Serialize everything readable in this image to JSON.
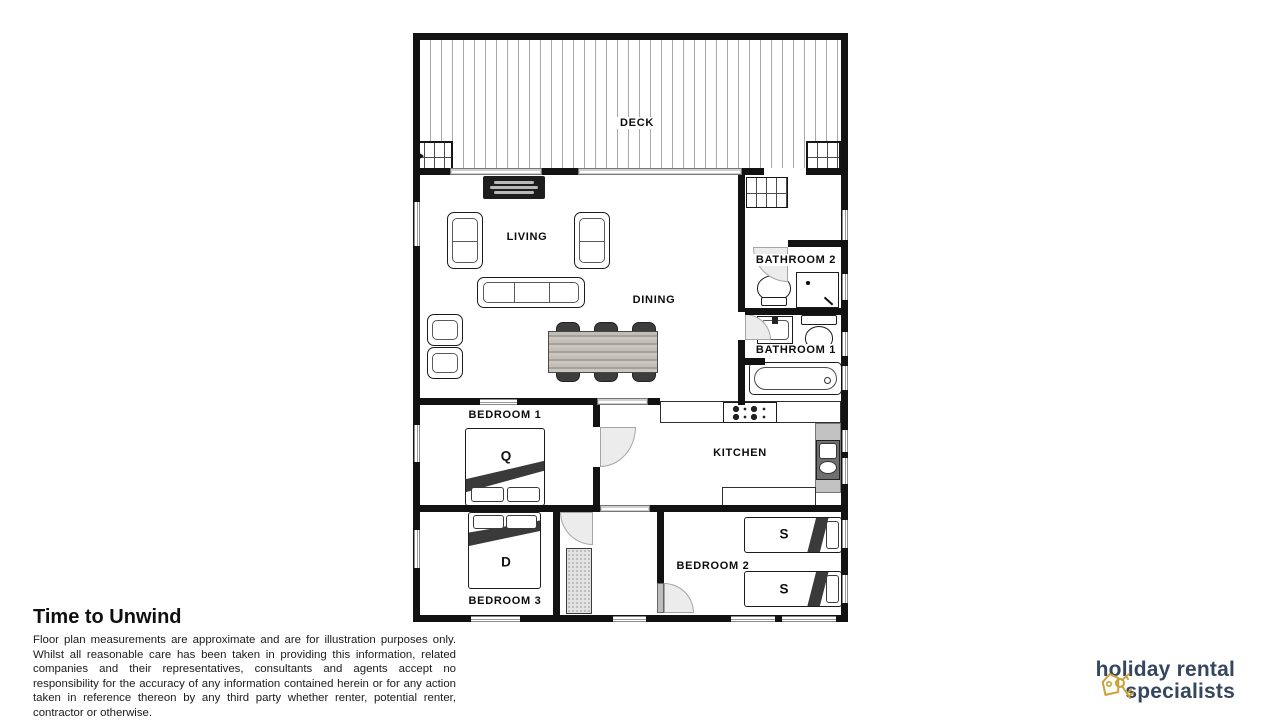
{
  "floorplan": {
    "rooms": [
      {
        "name": "deck",
        "label": "DECK"
      },
      {
        "name": "living",
        "label": "LIVING"
      },
      {
        "name": "dining",
        "label": "DINING"
      },
      {
        "name": "bathroom-2",
        "label": "BATHROOM 2"
      },
      {
        "name": "bathroom-1",
        "label": "BATHROOM 1"
      },
      {
        "name": "kitchen",
        "label": "KITCHEN"
      },
      {
        "name": "bedroom-1",
        "label": "BEDROOM 1"
      },
      {
        "name": "bedroom-2",
        "label": "BEDROOM 2"
      },
      {
        "name": "bedroom-3",
        "label": "BEDROOM 3"
      }
    ],
    "beds": [
      {
        "room": "bedroom-1",
        "size_label": "Q"
      },
      {
        "room": "bedroom-3",
        "size_label": "D"
      },
      {
        "room": "bedroom-2",
        "size_label": "S"
      },
      {
        "room": "bedroom-2",
        "size_label": "S"
      }
    ]
  },
  "footer": {
    "property_title": "Time to Unwind",
    "disclaimer": "Floor plan measurements are approximate and are for illustration purposes only. Whilst all reasonable care has been taken in providing this information, related companies and their representatives, consultants and agents accept no responsibility for the accuracy of any information contained herein or for any action taken in reference thereon by any third party whether renter, potential renter, contractor or otherwise."
  },
  "logo": {
    "line1": "holiday rental",
    "line2": "specialists",
    "text_color": "#35465f",
    "icon_color": "#c9a13b",
    "icon": "key-tag-icon"
  }
}
